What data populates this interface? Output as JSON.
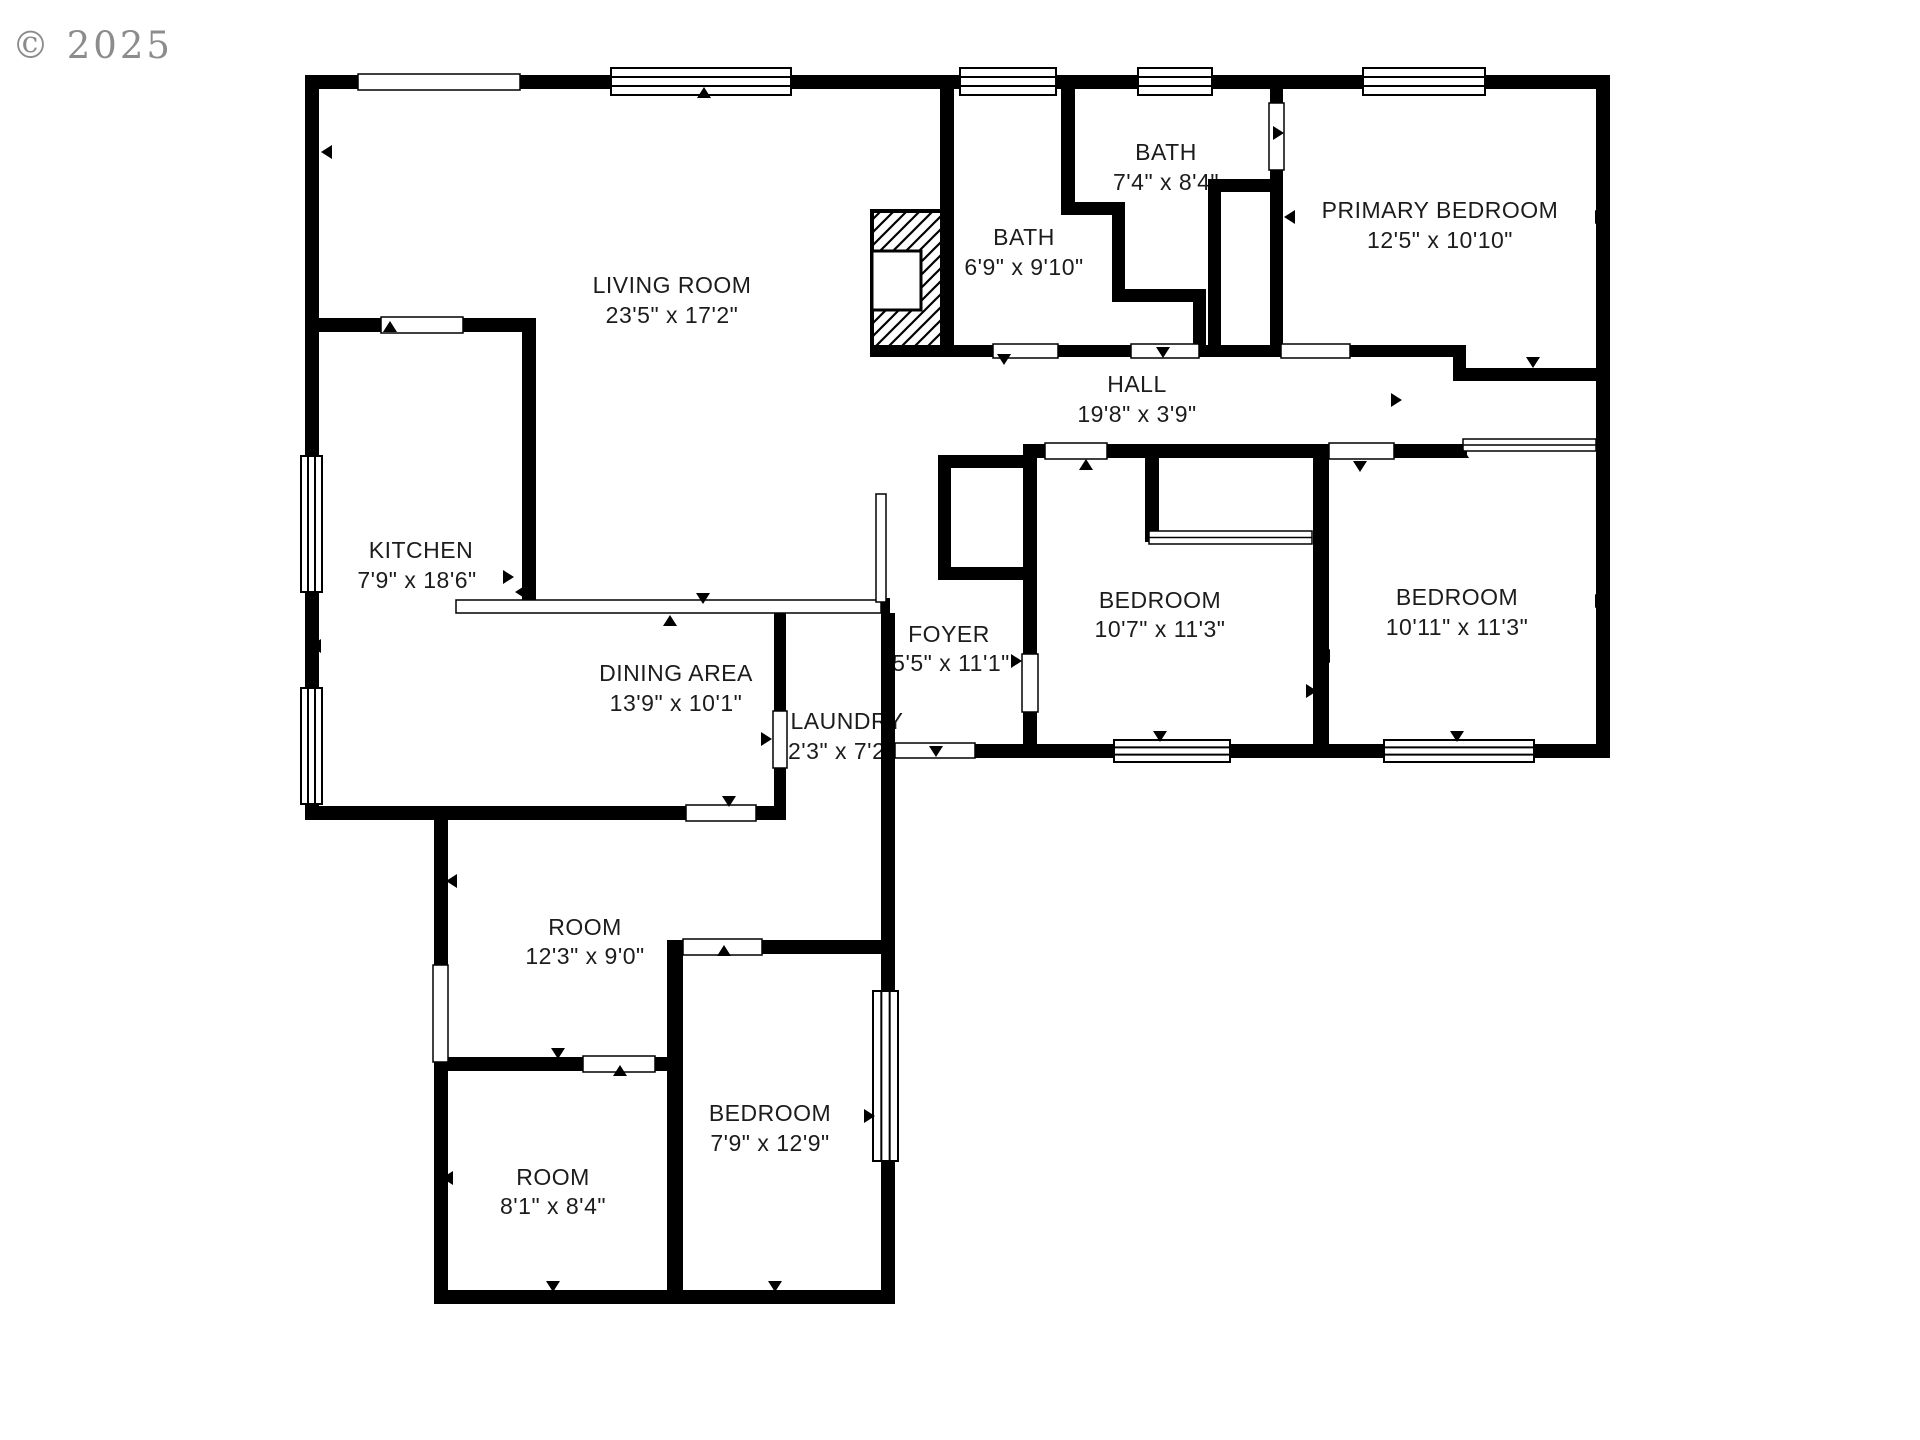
{
  "watermark": {
    "text": "© 2025"
  },
  "colors": {
    "wall": "#000000",
    "label_text": "#1c1c1c",
    "watermark_gray": "#8c8c8c",
    "background": "#ffffff"
  },
  "plan": {
    "type": "residential-floor-plan",
    "rooms": [
      {
        "id": "living-room",
        "name": "LIVING ROOM",
        "dims": "23'5\" x 17'2\""
      },
      {
        "id": "bath-1",
        "name": "BATH",
        "dims": "6'9\" x 9'10\""
      },
      {
        "id": "bath-2",
        "name": "BATH",
        "dims": "7'4\" x 8'4\""
      },
      {
        "id": "primary-bedroom",
        "name": "PRIMARY BEDROOM",
        "dims": "12'5\" x 10'10\""
      },
      {
        "id": "hall",
        "name": "HALL",
        "dims": "19'8\" x 3'9\""
      },
      {
        "id": "kitchen",
        "name": "KITCHEN",
        "dims": "7'9\" x 18'6\""
      },
      {
        "id": "dining-area",
        "name": "DINING AREA",
        "dims": "13'9\" x 10'1\""
      },
      {
        "id": "foyer",
        "name": "FOYER",
        "dims": "5'5\" x 11'1\""
      },
      {
        "id": "laundry",
        "name": "LAUNDRY",
        "dims": "2'3\" x 7'2\""
      },
      {
        "id": "bedroom-1",
        "name": "BEDROOM",
        "dims": "10'7\" x 11'3\""
      },
      {
        "id": "bedroom-2",
        "name": "BEDROOM",
        "dims": "10'11\" x 11'3\""
      },
      {
        "id": "room-1",
        "name": "ROOM",
        "dims": "12'3\" x 9'0\""
      },
      {
        "id": "room-2",
        "name": "ROOM",
        "dims": "8'1\" x 8'4\""
      },
      {
        "id": "bedroom-3",
        "name": "BEDROOM",
        "dims": "7'9\" x 12'9\""
      }
    ]
  }
}
